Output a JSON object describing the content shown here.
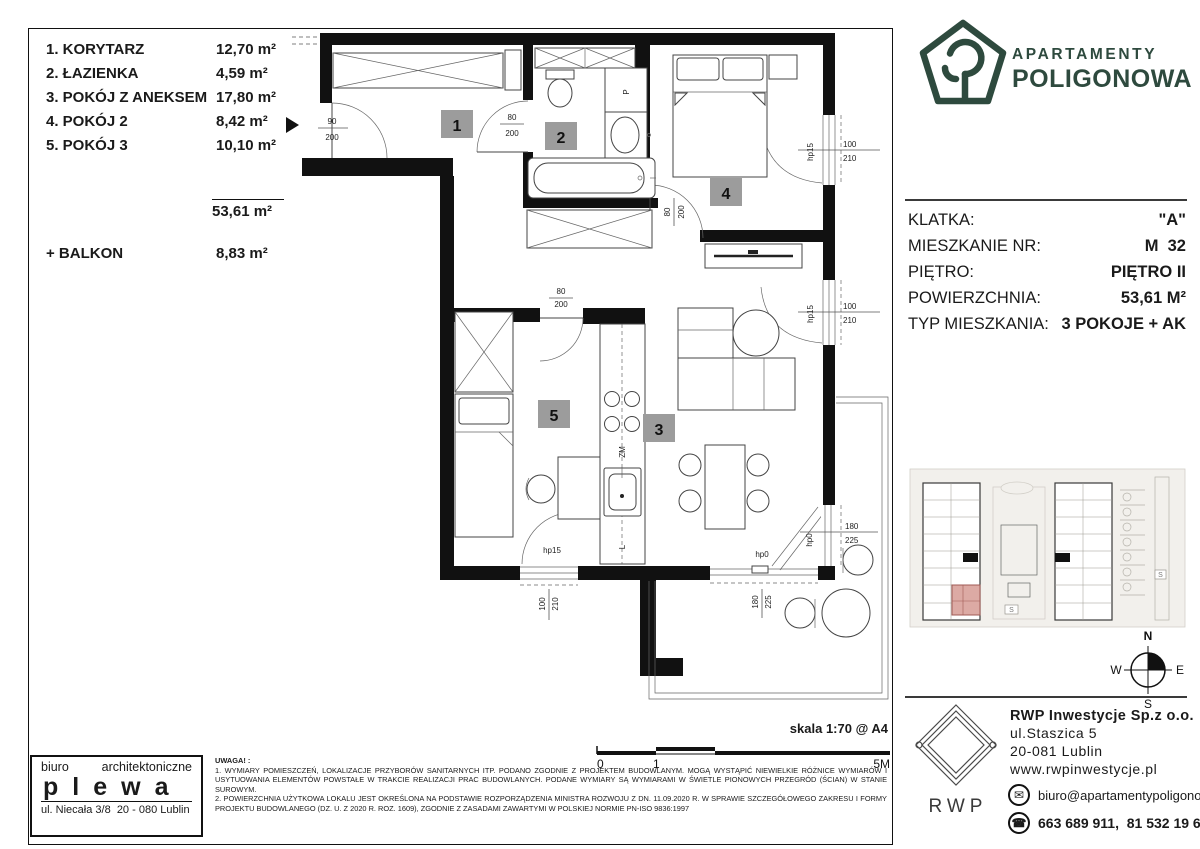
{
  "room_list": {
    "items": [
      {
        "label": "1. KORYTARZ",
        "area": "12,70 m²"
      },
      {
        "label": "2. ŁAZIENKA",
        "area": "4,59 m²"
      },
      {
        "label": "3. POKÓJ Z ANEKSEM",
        "area": "17,80 m²"
      },
      {
        "label": "4. POKÓJ 2",
        "area": "8,42 m²"
      },
      {
        "label": "5. POKÓJ 3",
        "area": "10,10 m²"
      }
    ],
    "total": "53,61 m²",
    "balcony_label": "+ BALKON",
    "balcony_area": "8,83 m²"
  },
  "brand": {
    "line1": "APARTAMENTY",
    "line2": "POLIGONOWA",
    "color": "#2e4a3e"
  },
  "info": {
    "rows": [
      {
        "label": "KLATKA:",
        "value": "\"A\""
      },
      {
        "label": "MIESZKANIE NR:",
        "value": "M  32"
      },
      {
        "label": "PIĘTRO:",
        "value": "PIĘTRO II"
      },
      {
        "label": "POWIERZCHNIA:",
        "value": "53,61 M²"
      },
      {
        "label": "TYP MIESZKANIA:",
        "value": "3 POKOJE + AK"
      }
    ]
  },
  "plan": {
    "labels": {
      "r1": "1",
      "r2": "2",
      "r3": "3",
      "r4": "4",
      "r5": "5"
    },
    "dims": {
      "d90": "90",
      "d200": "200",
      "d80": "80",
      "d100": "100",
      "d210": "210",
      "d180": "180",
      "d225": "225",
      "hp15": "hp15",
      "hp0": "hp0"
    },
    "kitchen": {
      "zm": "ZM",
      "l": "L"
    },
    "bath": {
      "p": "P"
    }
  },
  "scale": {
    "label": "skala 1:70 @ A4",
    "t0": "0",
    "t1": "1",
    "t2": "5M"
  },
  "notes": {
    "title": "UWAGA! :",
    "line1": "1. WYMIARY POMIESZCZEŃ, LOKALIZACJE PRZYBORÓW SANITARNYCH ITP. PODANO ZGODNIE Z PROJEKTEM BUDOWLANYM. MOGĄ WYSTĄPIĆ NIEWIELKIE RÓŻNICE WYMIARÓW I USYTUOWANIA ELEMENTÓW POWSTAŁE W TRAKCIE REALIZACJI PRAC BUDOWLANYCH. PODANE WYMIARY SĄ WYMIARAMI W ŚWIETLE PIONOWYCH PRZEGRÓD (ŚCIAN) W STANIE SUROWYM.",
    "line2": "2. POWIERZCHNIA UŻYTKOWA LOKALU JEST OKREŚLONA NA PODSTAWIE ROZPORZĄDZENIA MINISTRA ROZWOJU Z DN. 11.09.2020 R. W SPRAWIE SZCZEGÓŁOWEGO ZAKRESU I FORMY PROJEKTU BUDOWLANEGO (DZ. U. Z 2020 R. ROZ. 1609), ZGODNIE Z ZASADAMI ZAWARTYMI W POLSKIEJ NORMIE PN-ISO 9836:1997"
  },
  "architect": {
    "word1": "biuro",
    "word2": "architektoniczne",
    "name": "plewa",
    "address": "ul. Niecała 3/8  20 - 080 Lublin"
  },
  "developer": {
    "logo_text": "RWP",
    "name": "RWP Inwestycje Sp.z o.o.",
    "address1": "ul.Staszica 5",
    "address2": "20-081 Lublin",
    "website": "www.rwpinwestycje.pl",
    "email": "biuro@apartamentypoligonowa.pl",
    "phones": "663 689 911,  81 532 19 66",
    "email_icon": "✉",
    "phone_icon": "☎"
  },
  "compass": {
    "n": "N",
    "e": "E",
    "s": "S",
    "w": "W"
  },
  "minimap": {
    "s": "S"
  }
}
